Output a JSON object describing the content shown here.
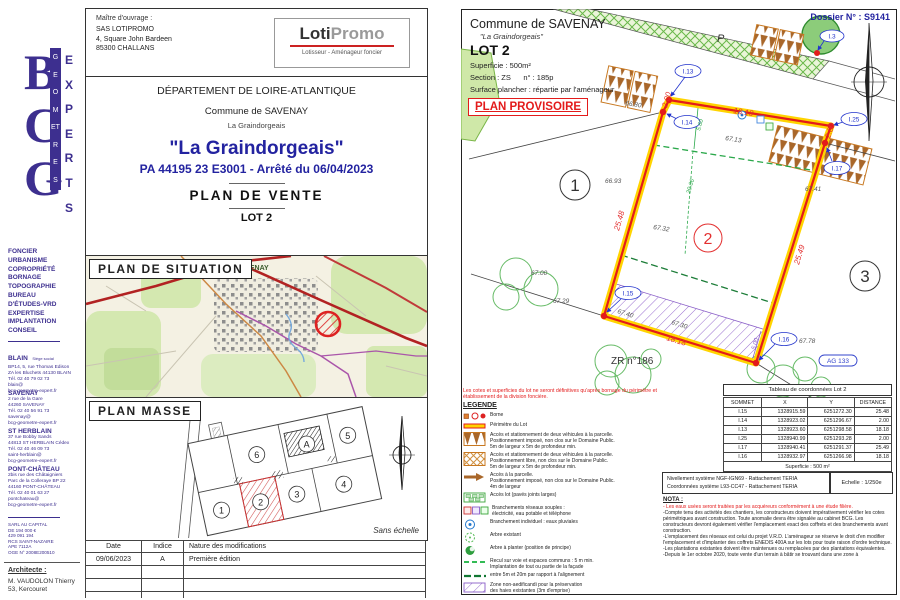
{
  "colors": {
    "accent_purple": "#3d2f8f",
    "title_blue": "#2323a0",
    "lot_red": "#e31b1b",
    "lot_yellow": "#ffd400",
    "zone_purple": "#8a5fc8",
    "hedge_brown": "#a9672a"
  },
  "sidebar": {
    "logo_letters": "BCG",
    "logo_word1": "GEOMETRES",
    "logo_word2": "EXPERTS",
    "services": "FONCIER\nURBANISME\nCOPROPRIÉTÉ\nBORNAGE\nTOPOGRAPHIE\nBUREAU\nD'ÉTUDES-VRD\nEXPERTISE\nIMPLANTATION\nCONSEIL",
    "office1_name": "BLAIN",
    "office1_tag": "Siège social",
    "office1_lines": "BP14, 5, rue Thomas Edison\nZA les Bluchets 44130 BLAIN\nTél. 02 40 79 02 73\nblain@\nbcg-geometre-expert.fr",
    "office2_name": "SAVENAY",
    "office2_lines": "2 rue de la Gare\n44260 SAVENAY\nTél. 02 40 56 91 73\nsavenay@\nbcg-geometre-expert.fr",
    "office3_name": "ST HERBLAIN",
    "office3_lines": "37 rue Bobby Sands\n44813 ST HERBLAIN Cédex\nTél. 02 40 46 09 73\nsaint-herblain@\nbcg-geometre-expert.fr",
    "office4_name": "PONT-CHÂTEAU",
    "office4_lines": "2bis rue des Châtaigniers\nParc de la Colleraye BP 22\n44160 PONT-CHÂTEAU\nTél. 02 40 01 63 27\npontchateau@\nbcg-geometre-expert.fr",
    "legal": "SARL AU CAPITAL\nDE 194 000 €\n429 091 194\nRCS SAINT-NAZAIRE\nAPE 7112A\nOGE N° 2008E200510",
    "architect_label": "Architecte :",
    "architect": "M. VAUDOLON Thierry\n53, Kercouret"
  },
  "owner": {
    "title": "Maître d'ouvrage :",
    "lines": "SAS LOTIPROMO\n4, Square John Bardeen\n85300 CHALLANS",
    "logo_a": "Loti",
    "logo_b": "Promo",
    "logo_sub": "Lotisseur - Aménageur foncier"
  },
  "title_block": {
    "departement": "DÉPARTEMENT DE LOIRE-ATLANTIQUE",
    "commune": "Commune de SAVENAY",
    "lieu": "La Graindorgeais",
    "project": "\"La Graindorgeais\"",
    "permit": "PA 44195 23 E3001 - Arrêté du 06/04/2023",
    "doc_type": "PLAN  DE  VENTE",
    "lot": "LOT 2"
  },
  "situation": {
    "title": "PLAN  DE  SITUATION",
    "city": "SAVENAY"
  },
  "masse": {
    "title": "PLAN  MASSE",
    "scale": "Sans échelle",
    "n1": "1",
    "n2": "2",
    "n3": "3",
    "n4": "4",
    "n5": "5",
    "n6": "6",
    "na": "A"
  },
  "mods": {
    "h1": "Date",
    "h2": "Indice",
    "h3": "Nature des modifications",
    "r1c1": "09/06/2023",
    "r1c2": "A",
    "r1c3": "Première édition"
  },
  "rp": {
    "commune": "Commune de SAVENAY",
    "lieu": "\"La Graindorgeais\"",
    "dossier": "Dossier N° : S9141",
    "lot": "LOT 2",
    "l1": "Superficie :  500m²",
    "l2": "Section : ZS      n° : 185p",
    "l3": "Surface plancher : répartie par l'aménageur",
    "prov": "PLAN PROVISOIRE",
    "note": "Les cotes et superficies du lot ne seront définitives qu'après bornage du périmètre et\nétablissement de la division foncière."
  },
  "plan": {
    "p": "P",
    "zr": "ZR n°186",
    "ag": "AG 133",
    "i13": "I.13",
    "i14": "I.14",
    "i25": "I.25",
    "i17": "I.17",
    "i15": "I.15",
    "i16": "I.16",
    "i3": "I.3",
    "d_top": "18.18",
    "d_left": "25.48",
    "d_right": "25.49",
    "d_bottom": "18.18",
    "d_2a": "2.00",
    "d_2b": "2.00",
    "g_560": "5.60",
    "g_2066": "20.66",
    "p_500": "5.00",
    "s_6693": "66.93",
    "s_6713": "67.13",
    "s_6732": "67.32",
    "s_6741": "67.41",
    "s_6700": "67.00",
    "s_6729": "67.29",
    "s_6778": "67.78",
    "s_6740": "67.40",
    "s_6730": "67.30",
    "s_6680": "66.80",
    "n1": "1",
    "n2": "2",
    "n3": "3"
  },
  "legend": {
    "title": "LEGENDE",
    "i1": "Borne",
    "i2": "Périmètre du Lot",
    "i3": "Accès et stationnement de deux véhicules à la parcelle.\nPositionnement imposé, non clos sur le Domaine Public.\n5m de largeur x 5m de profondeur min.",
    "i4": "Accès et stationnement de deux véhicules à la parcelle.\nPositionnement libre, non clos sur le Domaine Public.\n5m de largeur x 5m de profondeur min.",
    "i5": "Accès à la parcelle.\nPositionnement imposé, non clos sur le Domaine Public.\n4m de largeur",
    "i6": "Accès lot (pavés joints larges)",
    "i7": "Branchements réseaux souples :\nélectricité, eau potable et téléphone",
    "i8": "Branchement individuel : eaux pluviales",
    "i9": "Arbre existant",
    "i10": "Arbre à planter (position de principe)",
    "i11": "Recul sur voie et espaces communs : 5 m min.\nImplantation de tout ou partie de la façade",
    "i12": "entre 5m et 20m par rapport à l'alignement",
    "i13": "Zone non-aedificandi pour la préservation\ndes haies existantes (3m d'emprise)"
  },
  "coords": {
    "title": "Tableau de coordonnées Lot 2",
    "h1": "SOMMET",
    "h2": "X",
    "h3": "Y",
    "h4": "DISTANCE",
    "rows": [
      [
        "I.15",
        "1328915.59",
        "6251272.30",
        "25.48"
      ],
      [
        "I.14",
        "1328923.02",
        "6251296.67",
        "2.00"
      ],
      [
        "I.13",
        "1328923.60",
        "6251298.58",
        "18.18"
      ],
      [
        "I.25",
        "1328940.99",
        "6251293.28",
        "2.00"
      ],
      [
        "I.17",
        "1328940.41",
        "6251291.37",
        "25.49"
      ],
      [
        "I.16",
        "1328932.97",
        "6251266.98",
        "18.18"
      ]
    ],
    "footer": "Superficie : 500 m²"
  },
  "georef": {
    "l1": "Nivellement système NGF-IGN69 - Rattachement TERIA",
    "l2": "Coordonnées système L93-CC47  - Rattachement TERIA",
    "scale": "Echelle : 1/250e"
  },
  "nota": {
    "title": "NOTA :",
    "red": "- Les eaux usées seront traitées par les acquéreurs conformément à une étude filière.",
    "p1": "-Compte tenu des activités des chantiers, les constructeurs doivent impérativement vérifier les cotes périmétriques avant construction. Toute anomalie devra être signalée au cabinet BCG. Les constructeurs devront également vérifier l'emplacement exact des coffrets et des branchements avant construction.",
    "p2": "-L'emplacement des réseaux est celui du projet V.R.D. L'aménageur se réserve le droit d'en modifier l'emplacement et d'implanter des coffrets ENEDIS 400A sur les lots pour toute raison d'ordre technique.",
    "p3": "-Les plantations existantes doivent être maintenues ou remplacées par des plantations équivalentes.",
    "p4": "-Depuis le 1er octobre 2020, toute vente d'un terrain à bâtir se trouvant dans une zone à"
  }
}
